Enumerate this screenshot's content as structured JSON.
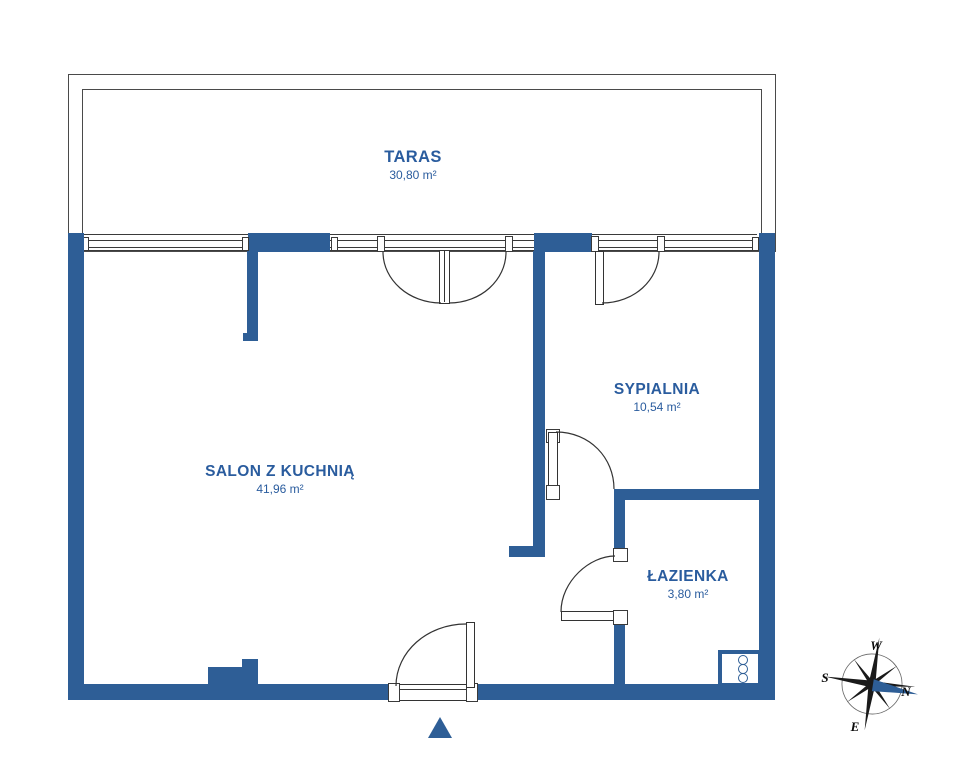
{
  "plan": {
    "rooms": [
      {
        "id": "taras",
        "name": "TARAS",
        "area": "30,80 m²"
      },
      {
        "id": "salon",
        "name": "SALON Z KUCHNIĄ",
        "area": "41,96 m²"
      },
      {
        "id": "sypialnia",
        "name": "SYPIALNIA",
        "area": "10,54 m²"
      },
      {
        "id": "lazienka",
        "name": "ŁAZIENKA",
        "area": "3,80 m²"
      }
    ]
  },
  "compass": {
    "west": "W",
    "south": "S",
    "north": "N",
    "east": "E"
  },
  "colors": {
    "wall": "#2E5E96",
    "room_label": "#2A5C9E",
    "thin_line": "#3A3A3A",
    "compass_needle": "#2E5E96"
  }
}
